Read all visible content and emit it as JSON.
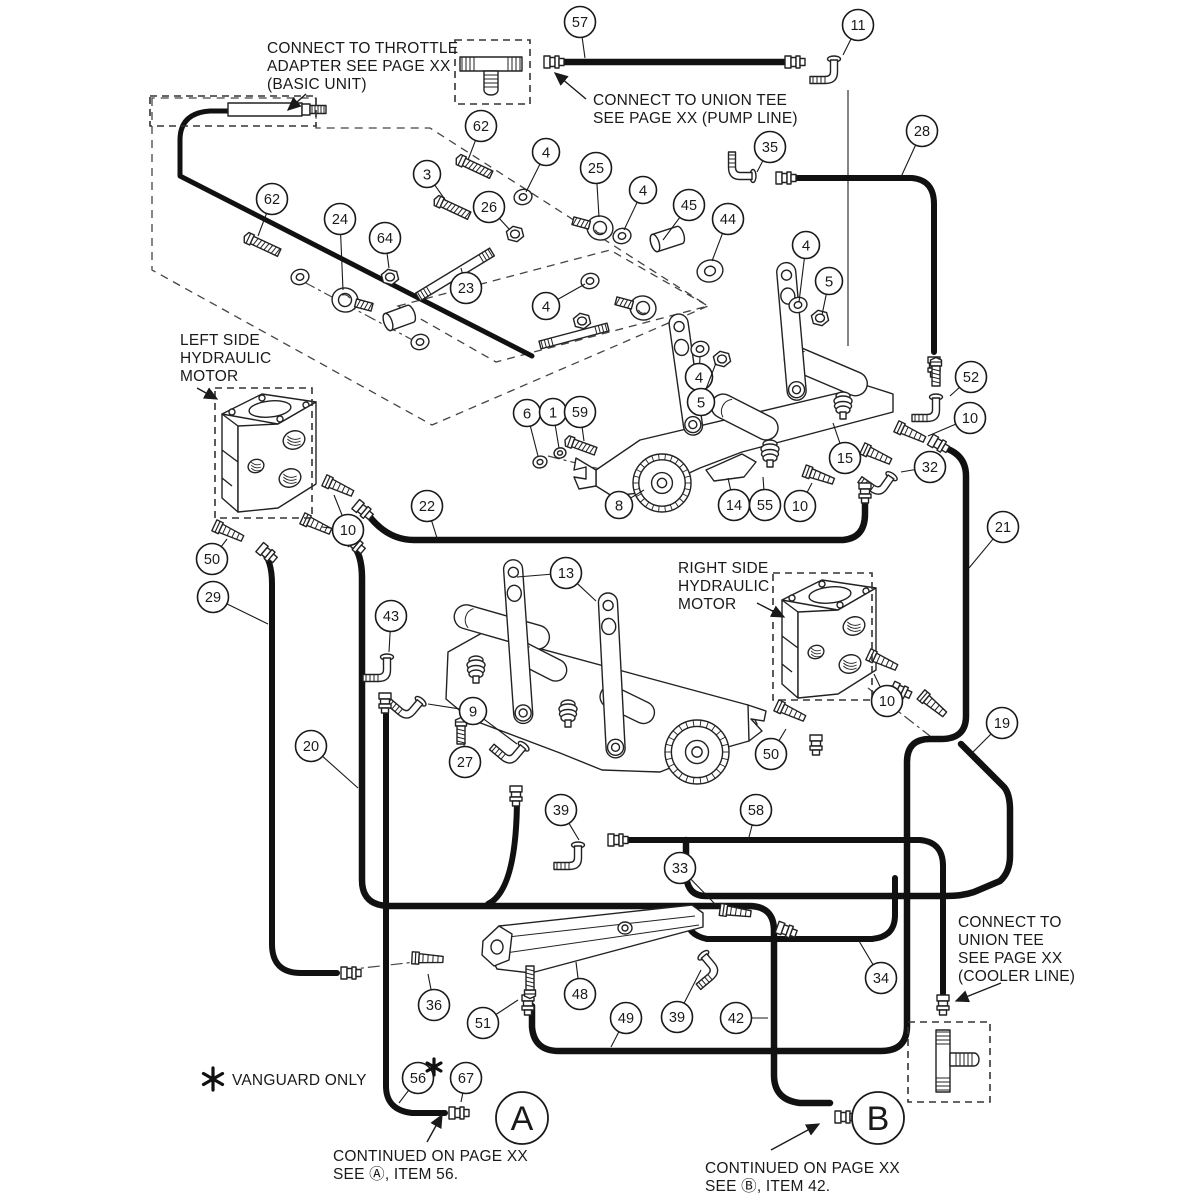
{
  "doc": {
    "type": "exploded parts diagram",
    "subject": "hydraulic hose and linkage assembly"
  },
  "colors": {
    "line": "#222222",
    "hose": "#111111",
    "text": "#1a1a1a",
    "bg": "#ffffff"
  },
  "annotations": [
    {
      "id": "throttle-note",
      "x": 267,
      "y": 40,
      "lines": [
        "CONNECT TO THROTTLE",
        "ADAPTER SEE PAGE XX",
        "(BASIC UNIT)"
      ],
      "arrow": [
        306,
        94,
        288,
        110
      ]
    },
    {
      "id": "pump-line-note",
      "x": 593,
      "y": 92,
      "lines": [
        "CONNECT TO UNION TEE",
        "SEE PAGE XX (PUMP LINE)"
      ],
      "arrow": [
        586,
        99,
        555,
        73
      ]
    },
    {
      "id": "left-motor-label",
      "x": 180,
      "y": 332,
      "lines": [
        "LEFT SIDE",
        "HYDRAULIC",
        "MOTOR"
      ],
      "arrow": [
        197,
        388,
        217,
        399
      ]
    },
    {
      "id": "right-motor-label",
      "x": 678,
      "y": 560,
      "lines": [
        "RIGHT SIDE",
        "HYDRAULIC",
        "MOTOR"
      ],
      "arrow": [
        757,
        603,
        784,
        617
      ]
    },
    {
      "id": "cooler-line-note",
      "x": 958,
      "y": 914,
      "lines": [
        "CONNECT TO",
        "UNION TEE",
        "SEE PAGE XX",
        "(COOLER  LINE)"
      ],
      "arrow": [
        1001,
        983,
        956,
        1001
      ]
    },
    {
      "id": "vanguard-note",
      "x": 232,
      "y": 1072,
      "lines": [
        "VANGUARD ONLY"
      ],
      "star": [
        213,
        1079,
        11
      ]
    },
    {
      "id": "continued-a",
      "x": 333,
      "y": 1148,
      "lines": [
        "CONTINUED ON PAGE XX",
        "SEE Ⓐ,  ITEM 56."
      ],
      "arrow": [
        427,
        1142,
        442,
        1115
      ]
    },
    {
      "id": "continued-b",
      "x": 705,
      "y": 1160,
      "lines": [
        "CONTINUED ON PAGE XX",
        "SEE Ⓑ,  ITEM 42."
      ],
      "arrow": [
        771,
        1150,
        819,
        1124
      ]
    }
  ],
  "extra_star": [
    434,
    1067,
    8
  ],
  "big_callouts": [
    {
      "label": "A",
      "x": 522,
      "y": 1118
    },
    {
      "label": "B",
      "x": 878,
      "y": 1118
    }
  ],
  "callouts": [
    {
      "n": "57",
      "x": 580,
      "y": 22,
      "t": [
        585,
        58
      ]
    },
    {
      "n": "11",
      "x": 858,
      "y": 25,
      "t": [
        843,
        55
      ]
    },
    {
      "n": "28",
      "x": 922,
      "y": 131,
      "t": [
        901,
        177
      ]
    },
    {
      "n": "62",
      "x": 481,
      "y": 126,
      "t": [
        468,
        160
      ]
    },
    {
      "n": "4",
      "x": 546,
      "y": 152,
      "t": [
        526,
        192
      ]
    },
    {
      "n": "25",
      "x": 596,
      "y": 168,
      "t": [
        599,
        217
      ]
    },
    {
      "n": "3",
      "x": 427,
      "y": 174,
      "t": [
        446,
        201
      ]
    },
    {
      "n": "4",
      "x": 643,
      "y": 190,
      "t": [
        624,
        230
      ]
    },
    {
      "n": "45",
      "x": 689,
      "y": 205,
      "t": [
        663,
        240
      ]
    },
    {
      "n": "44",
      "x": 728,
      "y": 219,
      "t": [
        712,
        261
      ]
    },
    {
      "n": "35",
      "x": 770,
      "y": 147,
      "t": [
        757,
        172
      ]
    },
    {
      "n": "62",
      "x": 272,
      "y": 199,
      "t": [
        258,
        236
      ]
    },
    {
      "n": "24",
      "x": 340,
      "y": 219,
      "t": [
        343,
        290
      ]
    },
    {
      "n": "64",
      "x": 385,
      "y": 238,
      "t": [
        389,
        268
      ]
    },
    {
      "n": "26",
      "x": 489,
      "y": 207,
      "t": [
        509,
        229
      ]
    },
    {
      "n": "23",
      "x": 466,
      "y": 288,
      "t": [
        461,
        268
      ]
    },
    {
      "n": "4",
      "x": 546,
      "y": 306,
      "t": [
        585,
        284
      ]
    },
    {
      "n": "4",
      "x": 806,
      "y": 245,
      "t": [
        799,
        302
      ]
    },
    {
      "n": "5",
      "x": 829,
      "y": 281,
      "t": [
        822,
        315
      ]
    },
    {
      "n": "4",
      "x": 699,
      "y": 377,
      "t": [
        700,
        357
      ]
    },
    {
      "n": "5",
      "x": 701,
      "y": 402,
      "t": [
        716,
        363
      ]
    },
    {
      "n": "6",
      "x": 527,
      "y": 413,
      "t": [
        538,
        456
      ]
    },
    {
      "n": "1",
      "x": 553,
      "y": 412,
      "t": [
        559,
        448
      ]
    },
    {
      "n": "59",
      "x": 580,
      "y": 412,
      "t": [
        584,
        441
      ]
    },
    {
      "n": "8",
      "x": 619,
      "y": 505,
      "t": [
        644,
        490
      ]
    },
    {
      "n": "14",
      "x": 734,
      "y": 505,
      "t": [
        728,
        478
      ]
    },
    {
      "n": "55",
      "x": 765,
      "y": 505,
      "t": [
        763,
        477
      ]
    },
    {
      "n": "10",
      "x": 800,
      "y": 506,
      "t": [
        812,
        483
      ]
    },
    {
      "n": "15",
      "x": 845,
      "y": 458,
      "t": [
        833,
        423
      ]
    },
    {
      "n": "52",
      "x": 971,
      "y": 377,
      "t": [
        950,
        396
      ]
    },
    {
      "n": "10",
      "x": 970,
      "y": 418,
      "t": [
        928,
        436
      ]
    },
    {
      "n": "32",
      "x": 930,
      "y": 467,
      "t": [
        901,
        472
      ]
    },
    {
      "n": "21",
      "x": 1003,
      "y": 527,
      "t": [
        969,
        568
      ]
    },
    {
      "n": "10",
      "x": 348,
      "y": 530,
      "t": [
        334,
        495
      ],
      "t2": [
        322,
        527
      ]
    },
    {
      "n": "22",
      "x": 427,
      "y": 506,
      "t": [
        437,
        538
      ]
    },
    {
      "n": "50",
      "x": 212,
      "y": 559,
      "t": [
        227,
        539
      ]
    },
    {
      "n": "29",
      "x": 213,
      "y": 597,
      "t": [
        268,
        624
      ]
    },
    {
      "n": "43",
      "x": 391,
      "y": 616,
      "t": [
        389,
        652
      ]
    },
    {
      "n": "13",
      "x": 566,
      "y": 573,
      "t": [
        517,
        577
      ],
      "t2": [
        596,
        601
      ]
    },
    {
      "n": "9",
      "x": 473,
      "y": 711,
      "t": [
        428,
        704
      ],
      "t2": [
        517,
        744
      ]
    },
    {
      "n": "27",
      "x": 465,
      "y": 762,
      "t": [
        464,
        744
      ]
    },
    {
      "n": "20",
      "x": 311,
      "y": 746,
      "t": [
        358,
        788
      ]
    },
    {
      "n": "39",
      "x": 561,
      "y": 810,
      "t": [
        579,
        840
      ]
    },
    {
      "n": "58",
      "x": 756,
      "y": 810,
      "t": [
        748,
        841
      ]
    },
    {
      "n": "33",
      "x": 680,
      "y": 868,
      "t": [
        716,
        905
      ]
    },
    {
      "n": "10",
      "x": 887,
      "y": 701,
      "t": [
        874,
        674
      ]
    },
    {
      "n": "50",
      "x": 771,
      "y": 754,
      "t": [
        786,
        729
      ]
    },
    {
      "n": "19",
      "x": 1002,
      "y": 723,
      "t": [
        973,
        752
      ]
    },
    {
      "n": "34",
      "x": 881,
      "y": 978,
      "t": [
        859,
        941
      ]
    },
    {
      "n": "36",
      "x": 434,
      "y": 1005,
      "t": [
        428,
        974
      ]
    },
    {
      "n": "48",
      "x": 580,
      "y": 994,
      "t": [
        576,
        962
      ]
    },
    {
      "n": "51",
      "x": 483,
      "y": 1023,
      "t": [
        518,
        1000
      ]
    },
    {
      "n": "49",
      "x": 626,
      "y": 1018,
      "t": [
        611,
        1047
      ]
    },
    {
      "n": "39",
      "x": 677,
      "y": 1017,
      "t": [
        701,
        970
      ]
    },
    {
      "n": "42",
      "x": 736,
      "y": 1018,
      "t": [
        768,
        1018
      ]
    },
    {
      "n": "56",
      "x": 418,
      "y": 1078,
      "t": [
        399,
        1103
      ]
    },
    {
      "n": "67",
      "x": 466,
      "y": 1078,
      "t": [
        461,
        1102
      ]
    }
  ],
  "dashed_boxes": [
    {
      "id": "throttle-box",
      "x": 150,
      "y": 96,
      "w": 166,
      "h": 30
    },
    {
      "id": "pump-tee-box",
      "x": 455,
      "y": 40,
      "w": 75,
      "h": 64
    },
    {
      "id": "left-motor-box",
      "x": 215,
      "y": 388,
      "w": 97,
      "h": 130
    },
    {
      "id": "right-motor-box",
      "x": 773,
      "y": 573,
      "w": 99,
      "h": 127
    },
    {
      "id": "cooler-tee-box",
      "x": 908,
      "y": 1022,
      "w": 82,
      "h": 80
    }
  ],
  "dashed_polys": [
    "152,98 152,270 432,425 708,306 430,128 316,128 316,98",
    "398,306 610,250 708,306 496,362"
  ],
  "dash_dot_lines": [
    "M345,970 L424,961",
    "M868,688 L930,736",
    "M304,282 L420,344",
    "M548,456 L628,476"
  ],
  "thin_lines": [
    [
      848,
      90,
      848,
      346
    ]
  ],
  "hoses": [
    {
      "id": "throttle-cable",
      "w": 5,
      "d": "M303,111 H210 Q180,113 180,140 V176 L532,356"
    },
    {
      "id": "hose-57",
      "w": 6.5,
      "d": "M560,62 H798"
    },
    {
      "id": "hose-28",
      "w": 6,
      "d": "M788,178 H912 Q934,180 934,204 V352"
    },
    {
      "id": "hose-22",
      "w": 6.5,
      "d": "M366,512 Q386,540 414,540 H843 Q865,538 865,514 V490"
    },
    {
      "id": "hose-29",
      "w": 6,
      "d": "M262,551 Q272,560 272,584 V944 Q272,973 301,973 H337"
    },
    {
      "id": "hose-20-42",
      "w": 6.5,
      "d": "M352,544 Q362,554 362,578 V880 Q362,906 390,906 H749 Q774,906 774,931 V1075 Q774,1100 800,1103 H830"
    },
    {
      "id": "hose-jumper",
      "w": 6,
      "d": "M517,796 Q517,890 488,904"
    },
    {
      "id": "hose-56",
      "w": 6,
      "d": "M386,704 V1086 Q386,1110 412,1113 H445"
    },
    {
      "id": "hose-21-49",
      "w": 6.5,
      "d": "M938,446 Q966,452 966,476 V716 Q966,739 941,739 H930 Q907,739 907,762 V1026 Q907,1051 881,1051 H559 Q534,1051 532,1027 V1006"
    },
    {
      "id": "hose-19",
      "w": 6.5,
      "d": "M961,744 L1004,787 Q1010,794 1010,810 V856 Q1010,872 1000,881 L974,892 Q962,896 946,896 H706 Q686,896 686,872 V840"
    },
    {
      "id": "hose-58",
      "w": 6,
      "d": "M621,840 H920 Q943,842 943,866 V994"
    },
    {
      "id": "hose-34",
      "w": 6,
      "d": "M686,917 Q687,935 707,939 H872 Q895,937 895,915 V878"
    }
  ],
  "parts": {
    "washers": [
      [
        523,
        197,
        9
      ],
      [
        622,
        236,
        9
      ],
      [
        590,
        281,
        9
      ],
      [
        700,
        349,
        9
      ],
      [
        798,
        305,
        9
      ],
      [
        710,
        271,
        13
      ],
      [
        540,
        462,
        7
      ],
      [
        560,
        453,
        6
      ],
      [
        300,
        277,
        9
      ],
      [
        420,
        342,
        9
      ]
    ],
    "nuts": [
      [
        515,
        234,
        9
      ],
      [
        390,
        277,
        9
      ],
      [
        820,
        318,
        9
      ],
      [
        722,
        359,
        9
      ],
      [
        582,
        321,
        9
      ]
    ],
    "bolts": [
      [
        464,
        162,
        25,
        30
      ],
      [
        252,
        240,
        25,
        30
      ],
      [
        442,
        203,
        25,
        30
      ],
      [
        573,
        443,
        20,
        24
      ],
      [
        461,
        726,
        90,
        18
      ],
      [
        530,
        990,
        -90,
        24
      ],
      [
        936,
        366,
        90,
        20
      ]
    ],
    "rodends": [
      [
        600,
        228,
        195
      ],
      [
        345,
        300,
        15
      ],
      [
        643,
        308,
        195
      ]
    ],
    "spacers": [
      [
        655,
        243,
        -18,
        26,
        9
      ],
      [
        388,
        322,
        -20,
        24,
        9
      ]
    ],
    "rods": [
      [
        418,
        297,
        492,
        252,
        9
      ],
      [
        540,
        345,
        608,
        327,
        8
      ]
    ],
    "levers": [
      [
        668,
        316,
        122,
        -8
      ],
      [
        776,
        264,
        138,
        -5
      ],
      [
        503,
        561,
        164,
        -4
      ],
      [
        598,
        594,
        165,
        -3
      ]
    ],
    "elbows": [
      [
        834,
        60,
        0
      ],
      [
        752,
        176,
        90
      ],
      [
        936,
        398,
        0
      ],
      [
        891,
        477,
        35
      ],
      [
        387,
        658,
        0
      ],
      [
        578,
        846,
        0
      ],
      [
        704,
        956,
        320
      ],
      [
        420,
        702,
        40
      ],
      [
        523,
        747,
        40
      ]
    ],
    "barbs": [
      [
        900,
        428,
        25
      ],
      [
        328,
        482,
        25
      ],
      [
        306,
        520,
        25
      ],
      [
        218,
        527,
        25
      ],
      [
        780,
        707,
        25
      ],
      [
        872,
        656,
        25
      ],
      [
        724,
        910,
        8
      ],
      [
        416,
        958,
        3
      ],
      [
        808,
        472,
        20
      ],
      [
        866,
        450,
        25
      ],
      [
        924,
        697,
        40
      ]
    ],
    "flares": [
      [
        547,
        62,
        0
      ],
      [
        788,
        62,
        0
      ],
      [
        779,
        178,
        0
      ],
      [
        934,
        360,
        90
      ],
      [
        358,
        506,
        40
      ],
      [
        865,
        486,
        90
      ],
      [
        344,
        973,
        0
      ],
      [
        350,
        540,
        40
      ],
      [
        452,
        1113,
        0
      ],
      [
        838,
        1117,
        0
      ],
      [
        816,
        738,
        90
      ],
      [
        528,
        998,
        90
      ],
      [
        611,
        840,
        0
      ],
      [
        943,
        998,
        90
      ],
      [
        933,
        441,
        30
      ],
      [
        895,
        688,
        25
      ],
      [
        516,
        789,
        90
      ],
      [
        385,
        696,
        90
      ],
      [
        262,
        549,
        40
      ],
      [
        780,
        928,
        20
      ]
    ],
    "ballstuds": [
      [
        770,
        450
      ],
      [
        843,
        402
      ],
      [
        568,
        710
      ],
      [
        476,
        666
      ]
    ],
    "pulleys": [
      [
        662,
        483,
        29
      ],
      [
        697,
        752,
        32
      ]
    ],
    "polys": [
      "596,470 640,440 868,386 893,394 893,412 742,452 700,468 648,492 612,496 596,486",
      "596,470 576,458 574,470 586,467 586,479 574,477 579,489 596,486",
      "448,652 482,633 748,705 757,724 749,741 710,752 660,772 602,770 560,753 470,719 446,699",
      "748,705 766,711 764,721 751,719 762,731 749,741",
      "706,470 742,454 756,462 744,477 714,481"
    ],
    "cyls": [
      [
        718,
        390,
        72,
        24,
        27
      ],
      [
        790,
        343,
        88,
        24,
        23
      ],
      [
        458,
        602,
        98,
        24,
        16
      ],
      [
        517,
        638,
        60,
        22,
        27
      ],
      [
        606,
        682,
        58,
        22,
        26
      ]
    ],
    "blocks": [
      [
        218,
        392
      ],
      [
        778,
        578
      ]
    ],
    "tees": {
      "h": [
        458,
        44
      ],
      "v": [
        936,
        1026
      ]
    },
    "throttle_housing": [
      228,
      103,
      74,
      13
    ]
  }
}
